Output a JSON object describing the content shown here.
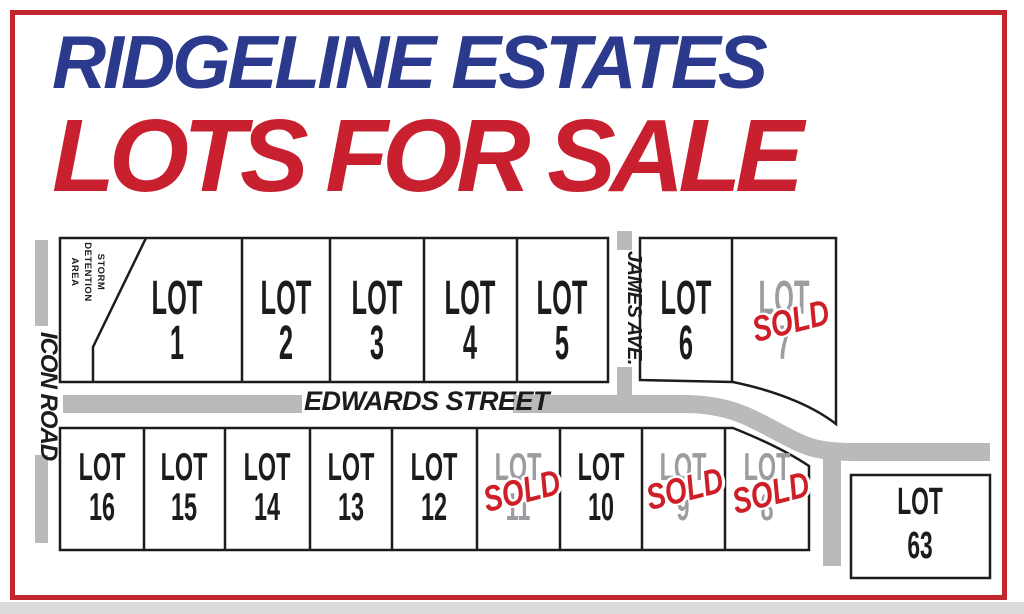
{
  "title": {
    "line1": "RIDGELINE ESTATES",
    "line2": "LOTS FOR SALE"
  },
  "roads": {
    "icon_road": "ICON ROAD",
    "james_ave": "JAMES AVE.",
    "edwards_street": "EDWARDS STREET"
  },
  "storm_area": {
    "line1": "STORM",
    "line2": "DETENTION",
    "line3": "AREA"
  },
  "stamp": "SOLD",
  "lots": [
    {
      "word": "LOT",
      "number": "1",
      "status": "available"
    },
    {
      "word": "LOT",
      "number": "2",
      "status": "available"
    },
    {
      "word": "LOT",
      "number": "3",
      "status": "available"
    },
    {
      "word": "LOT",
      "number": "4",
      "status": "available"
    },
    {
      "word": "LOT",
      "number": "5",
      "status": "available"
    },
    {
      "word": "LOT",
      "number": "6",
      "status": "available"
    },
    {
      "word": "LOT",
      "number": "7",
      "status": "sold"
    },
    {
      "word": "LOT",
      "number": "8",
      "status": "sold"
    },
    {
      "word": "LOT",
      "number": "9",
      "status": "sold"
    },
    {
      "word": "LOT",
      "number": "10",
      "status": "available"
    },
    {
      "word": "LOT",
      "number": "11",
      "status": "sold"
    },
    {
      "word": "LOT",
      "number": "12",
      "status": "available"
    },
    {
      "word": "LOT",
      "number": "13",
      "status": "available"
    },
    {
      "word": "LOT",
      "number": "14",
      "status": "available"
    },
    {
      "word": "LOT",
      "number": "15",
      "status": "available"
    },
    {
      "word": "LOT",
      "number": "16",
      "status": "available"
    },
    {
      "word": "LOT",
      "number": "63",
      "status": "available"
    }
  ],
  "colors": {
    "title_blue": "#2b3a8d",
    "title_red": "#c8202f",
    "border_red": "#c2262e",
    "sold_red": "#ce1f28",
    "road_gray": "#b9babc",
    "sold_gray": "#9b9da0",
    "line_black": "#1c1c1c"
  }
}
